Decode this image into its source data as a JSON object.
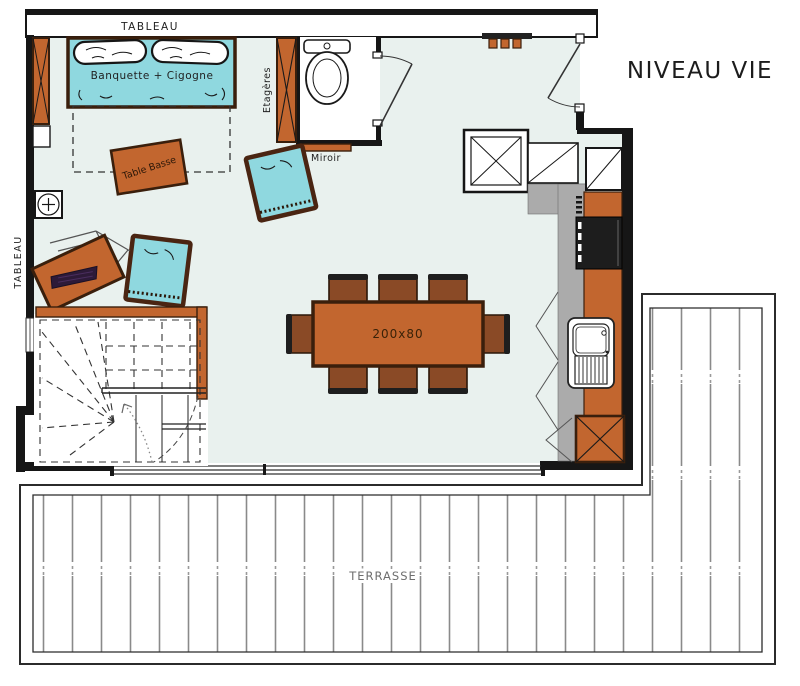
{
  "title": "NIVEAU VIE",
  "labels": {
    "tableau_top": "TABLEAU",
    "tableau_left": "TABLEAU",
    "banquette": "Banquette + Cigogne",
    "coffee_table": "Table Basse",
    "shelves": "Etagères",
    "mirror": "Miroir",
    "dining_table_size": "200x80",
    "terrace": "TERRASSE"
  },
  "colors": {
    "orange": "#C2662F",
    "orange_dark": "#3A1F0C",
    "teal": "#8FD8DF",
    "floor": "#E9F1EE",
    "wall": "#161616",
    "gray": "#ABABAB",
    "appliance": "#1D1D1D",
    "keyboard": "#2D1A38",
    "chair_brown": "#8A4A26",
    "plank_line": "#8A8A8A"
  }
}
